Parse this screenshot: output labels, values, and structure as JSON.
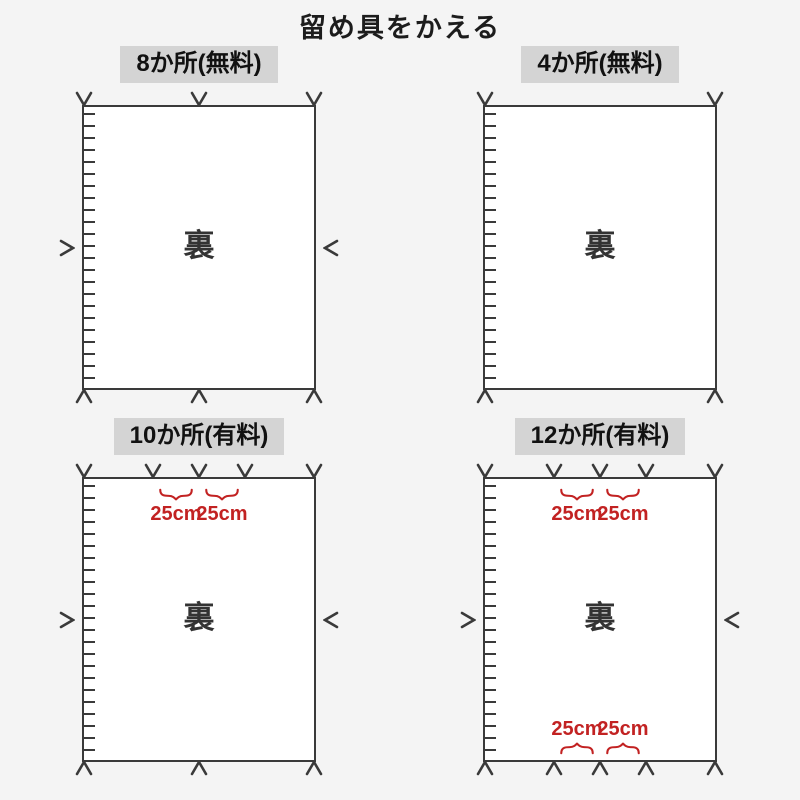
{
  "title": "留め具をかえる",
  "colors": {
    "background": "#f4f4f4",
    "sheet_fill": "#ffffff",
    "line": "#3a3a3a",
    "header_bg": "#d4d4d4",
    "accent_red": "#c22222"
  },
  "panels": [
    {
      "label": "8か所(無料)",
      "center_label": "裏",
      "marks": [
        {
          "edge": "top",
          "pos": 0
        },
        {
          "edge": "top",
          "pos": 50
        },
        {
          "edge": "top",
          "pos": 100
        },
        {
          "edge": "bottom",
          "pos": 0
        },
        {
          "edge": "bottom",
          "pos": 50
        },
        {
          "edge": "bottom",
          "pos": 100
        },
        {
          "edge": "left",
          "pos": 50
        },
        {
          "edge": "right",
          "pos": 50
        }
      ],
      "braces": []
    },
    {
      "label": "4か所(無料)",
      "center_label": "裏",
      "marks": [
        {
          "edge": "top",
          "pos": 0
        },
        {
          "edge": "top",
          "pos": 100
        },
        {
          "edge": "bottom",
          "pos": 0
        },
        {
          "edge": "bottom",
          "pos": 100
        }
      ],
      "braces": []
    },
    {
      "label": "10か所(有料)",
      "center_label": "裏",
      "marks": [
        {
          "edge": "top",
          "pos": 0
        },
        {
          "edge": "top",
          "pos": 30
        },
        {
          "edge": "top",
          "pos": 50
        },
        {
          "edge": "top",
          "pos": 70
        },
        {
          "edge": "top",
          "pos": 100
        },
        {
          "edge": "bottom",
          "pos": 0
        },
        {
          "edge": "bottom",
          "pos": 50
        },
        {
          "edge": "bottom",
          "pos": 100
        },
        {
          "edge": "left",
          "pos": 50
        },
        {
          "edge": "right",
          "pos": 50
        }
      ],
      "braces": [
        {
          "edge": "top",
          "from": 30,
          "to": 50,
          "label": "25cm"
        },
        {
          "edge": "top",
          "from": 50,
          "to": 70,
          "label": "25cm"
        }
      ]
    },
    {
      "label": "12か所(有料)",
      "center_label": "裏",
      "marks": [
        {
          "edge": "top",
          "pos": 0
        },
        {
          "edge": "top",
          "pos": 30
        },
        {
          "edge": "top",
          "pos": 50
        },
        {
          "edge": "top",
          "pos": 70
        },
        {
          "edge": "top",
          "pos": 100
        },
        {
          "edge": "bottom",
          "pos": 0
        },
        {
          "edge": "bottom",
          "pos": 30
        },
        {
          "edge": "bottom",
          "pos": 50
        },
        {
          "edge": "bottom",
          "pos": 70
        },
        {
          "edge": "bottom",
          "pos": 100
        },
        {
          "edge": "left",
          "pos": 50
        },
        {
          "edge": "right",
          "pos": 50
        }
      ],
      "braces": [
        {
          "edge": "top",
          "from": 30,
          "to": 50,
          "label": "25cm"
        },
        {
          "edge": "top",
          "from": 50,
          "to": 70,
          "label": "25cm"
        },
        {
          "edge": "bottom",
          "from": 30,
          "to": 50,
          "label": "25cm"
        },
        {
          "edge": "bottom",
          "from": 50,
          "to": 70,
          "label": "25cm"
        }
      ]
    }
  ]
}
